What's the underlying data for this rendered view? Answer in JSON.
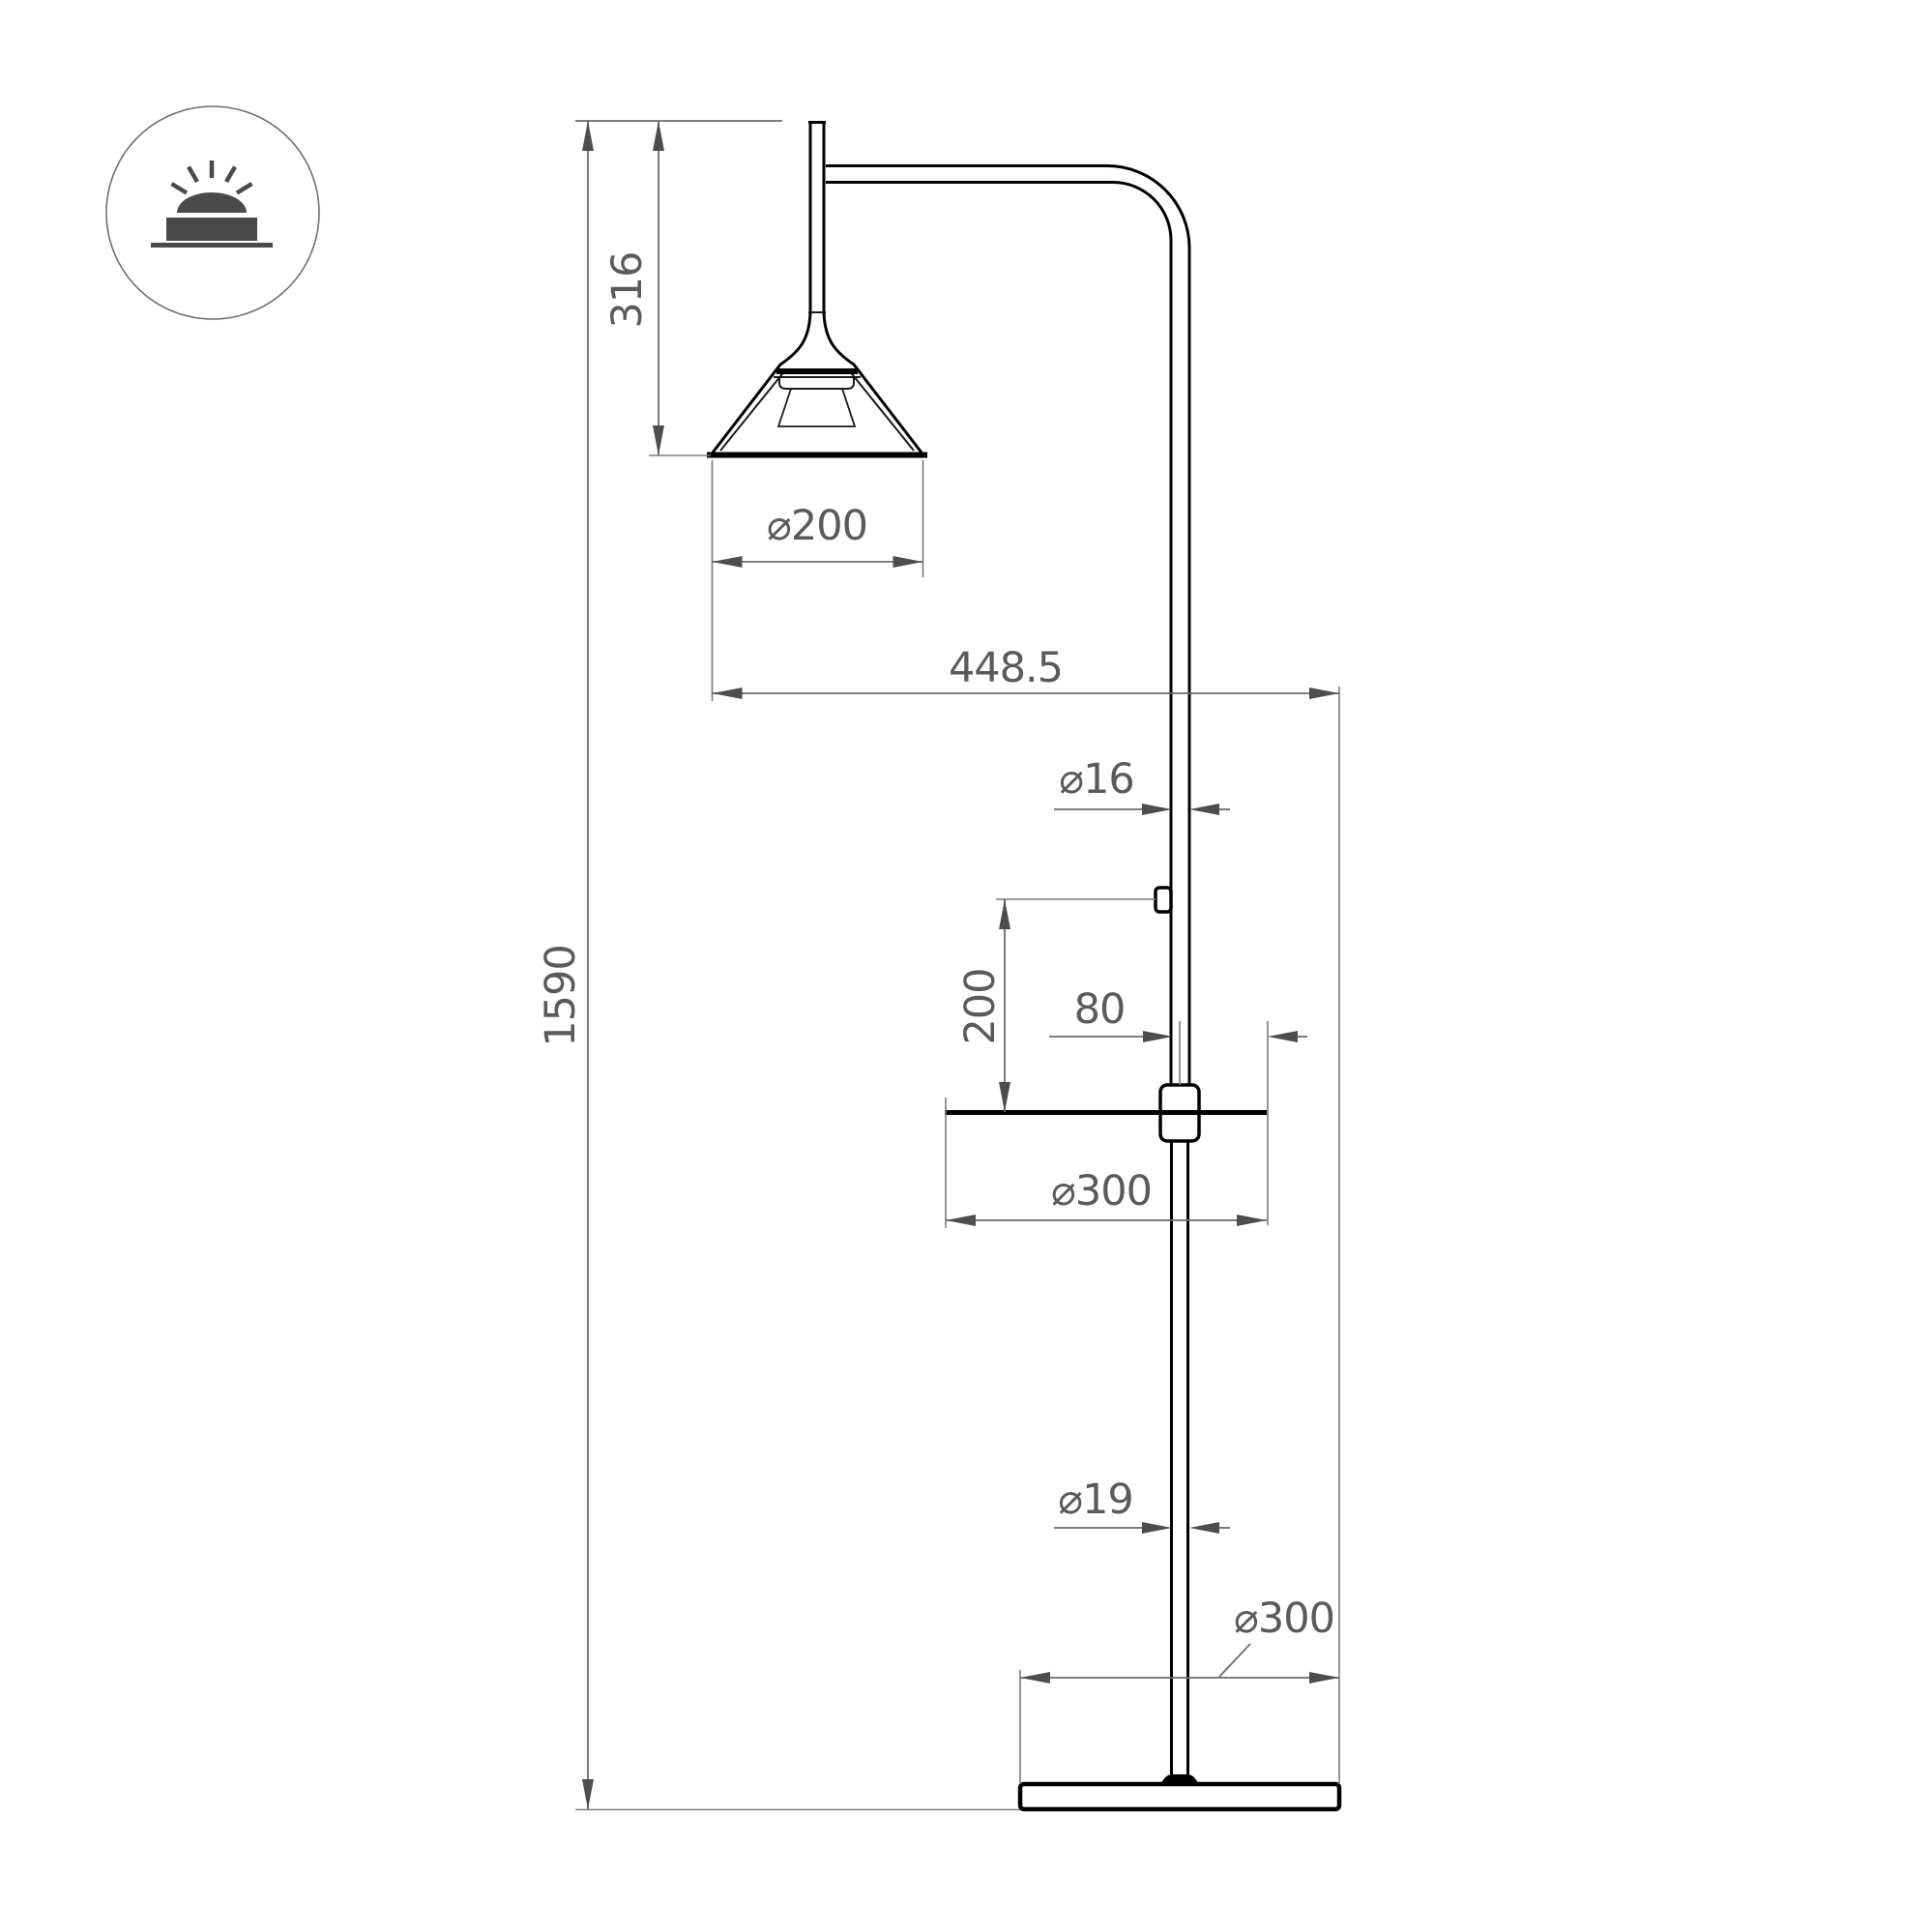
{
  "drawing": {
    "title": "floor-lamp-dimension-drawing",
    "colors": {
      "background": "#ffffff",
      "object_line": "#000000",
      "dimension_line": "#6a6a6a",
      "arrow": "#4d4d4d",
      "text": "#5a5a5a",
      "icon": "#4a4a4a"
    },
    "icon": {
      "name": "surface-mounted-light-icon"
    },
    "dims": {
      "total_height": {
        "label": "1590"
      },
      "head_drop": {
        "label": "316"
      },
      "shade_diameter": {
        "label": "⌀200"
      },
      "arm_offset": {
        "label": "448.5"
      },
      "upper_pole_diameter": {
        "label": "⌀16"
      },
      "switch_above_table": {
        "label": "200"
      },
      "table_edge_offset": {
        "label": "80"
      },
      "table_diameter": {
        "label": "⌀300"
      },
      "lower_pole_diameter": {
        "label": "⌀19"
      },
      "base_diameter": {
        "label": "⌀300"
      }
    }
  }
}
